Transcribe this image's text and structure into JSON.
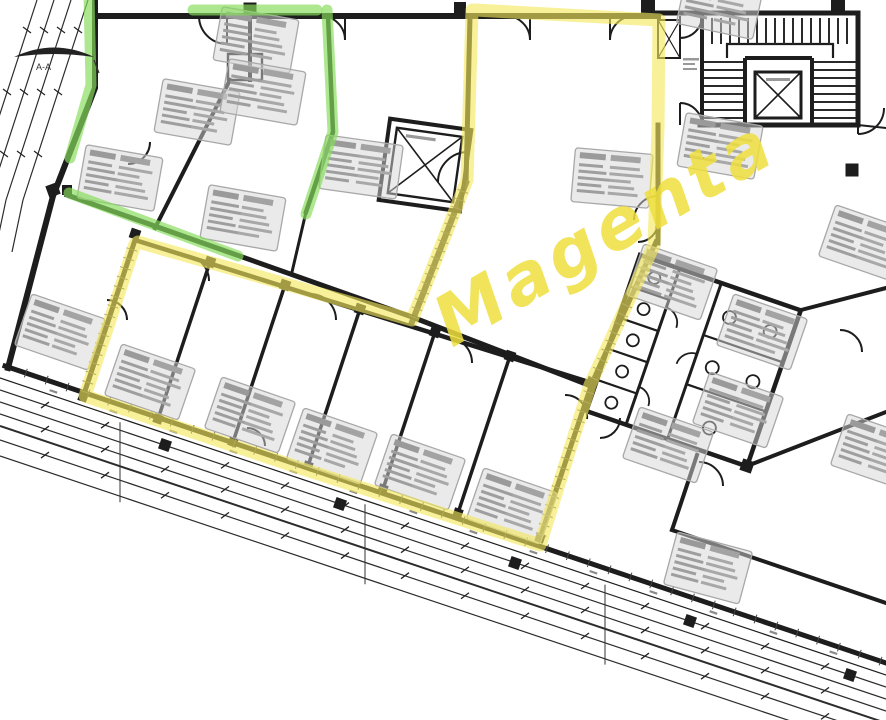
{
  "canvas": {
    "width": 886,
    "height": 720,
    "background": "#ffffff"
  },
  "annotations": {
    "magenta_label": {
      "text": "Magenta",
      "color": "#efdf3e",
      "rotation_deg": -30
    },
    "highlight_yellow": "#f3e85a",
    "highlight_green": "#86dd5c"
  },
  "section_marker": {
    "label": "A-A"
  },
  "plan": {
    "ink_color": "#1d1d1d",
    "tag_fill": "#d6d6d6",
    "tag_line_color": "#9a9a9a",
    "room_tag_count": 22,
    "features": [
      "staircase",
      "stair-elevator",
      "freight-elevator-shaft",
      "wc-block",
      "door-swing-arcs",
      "window-facade",
      "dimension-line-bundle"
    ]
  }
}
